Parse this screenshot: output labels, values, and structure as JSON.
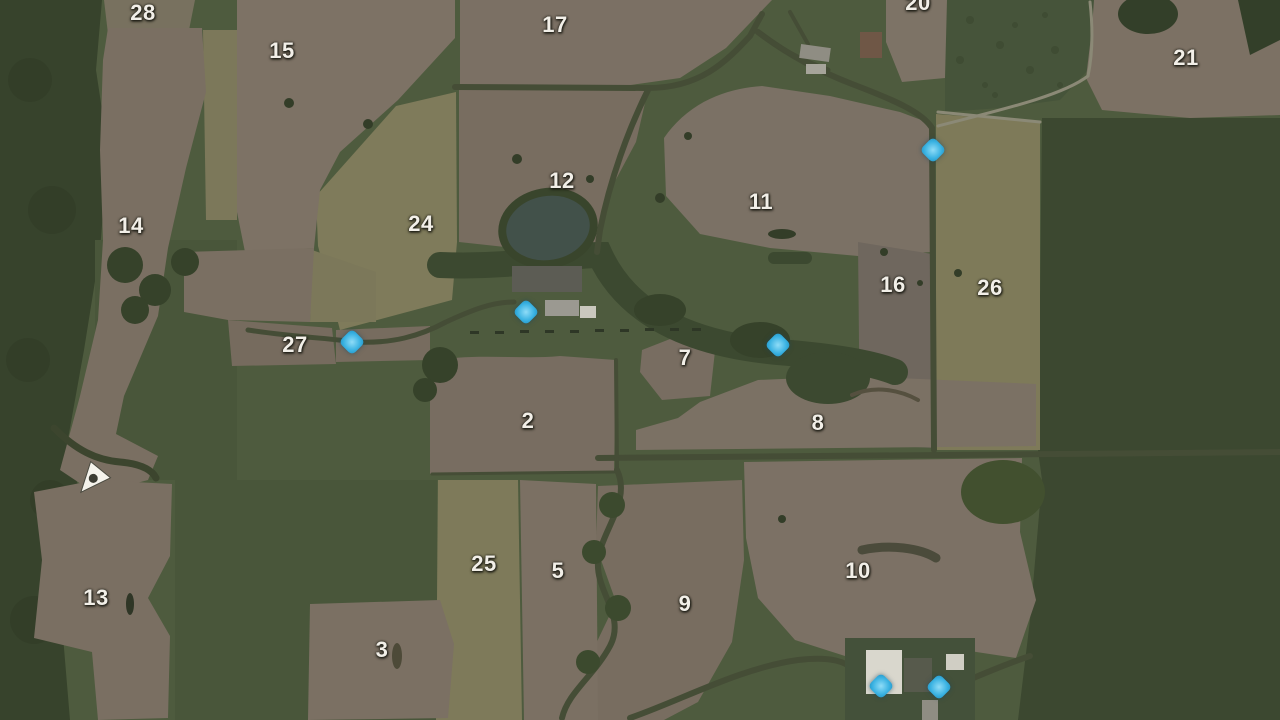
{
  "map": {
    "title": "field-map-overview",
    "field_labels": [
      {
        "id": "28",
        "x": 143,
        "y": 13
      },
      {
        "id": "15",
        "x": 282,
        "y": 51
      },
      {
        "id": "17",
        "x": 555,
        "y": 25
      },
      {
        "id": "20",
        "x": 918,
        "y": 3
      },
      {
        "id": "21",
        "x": 1186,
        "y": 58
      },
      {
        "id": "14",
        "x": 131,
        "y": 226
      },
      {
        "id": "24",
        "x": 421,
        "y": 224
      },
      {
        "id": "12",
        "x": 562,
        "y": 181
      },
      {
        "id": "11",
        "x": 761,
        "y": 202
      },
      {
        "id": "16",
        "x": 893,
        "y": 285
      },
      {
        "id": "26",
        "x": 990,
        "y": 288
      },
      {
        "id": "27",
        "x": 295,
        "y": 345
      },
      {
        "id": "7",
        "x": 685,
        "y": 358
      },
      {
        "id": "2",
        "x": 528,
        "y": 421
      },
      {
        "id": "8",
        "x": 818,
        "y": 423
      },
      {
        "id": "13",
        "x": 96,
        "y": 598
      },
      {
        "id": "25",
        "x": 484,
        "y": 564
      },
      {
        "id": "5",
        "x": 558,
        "y": 571
      },
      {
        "id": "9",
        "x": 685,
        "y": 604
      },
      {
        "id": "10",
        "x": 858,
        "y": 571
      },
      {
        "id": "3",
        "x": 382,
        "y": 650
      }
    ],
    "markers": [
      {
        "id": "marker-1",
        "x": 933,
        "y": 150
      },
      {
        "id": "marker-2",
        "x": 526,
        "y": 312
      },
      {
        "id": "marker-3",
        "x": 352,
        "y": 342
      },
      {
        "id": "marker-4",
        "x": 778,
        "y": 345
      },
      {
        "id": "marker-5",
        "x": 881,
        "y": 686
      },
      {
        "id": "marker-6",
        "x": 939,
        "y": 687
      }
    ],
    "player": {
      "x": 95,
      "y": 477,
      "rotation_deg": -12
    },
    "colors": {
      "grass_green": "#4e5b3e",
      "forest_green": "#37432c",
      "field_brown": "#7b7063",
      "field_khaki": "#7f7b5b",
      "road_dark": "#454d36",
      "water_dark": "#42514a",
      "marker_blue": "#3ab2e2",
      "marker_light": "#8fdcf7",
      "marker_dark": "#2090c0",
      "label_white": "#f2efe8",
      "player_white": "#f5f3ec"
    }
  }
}
